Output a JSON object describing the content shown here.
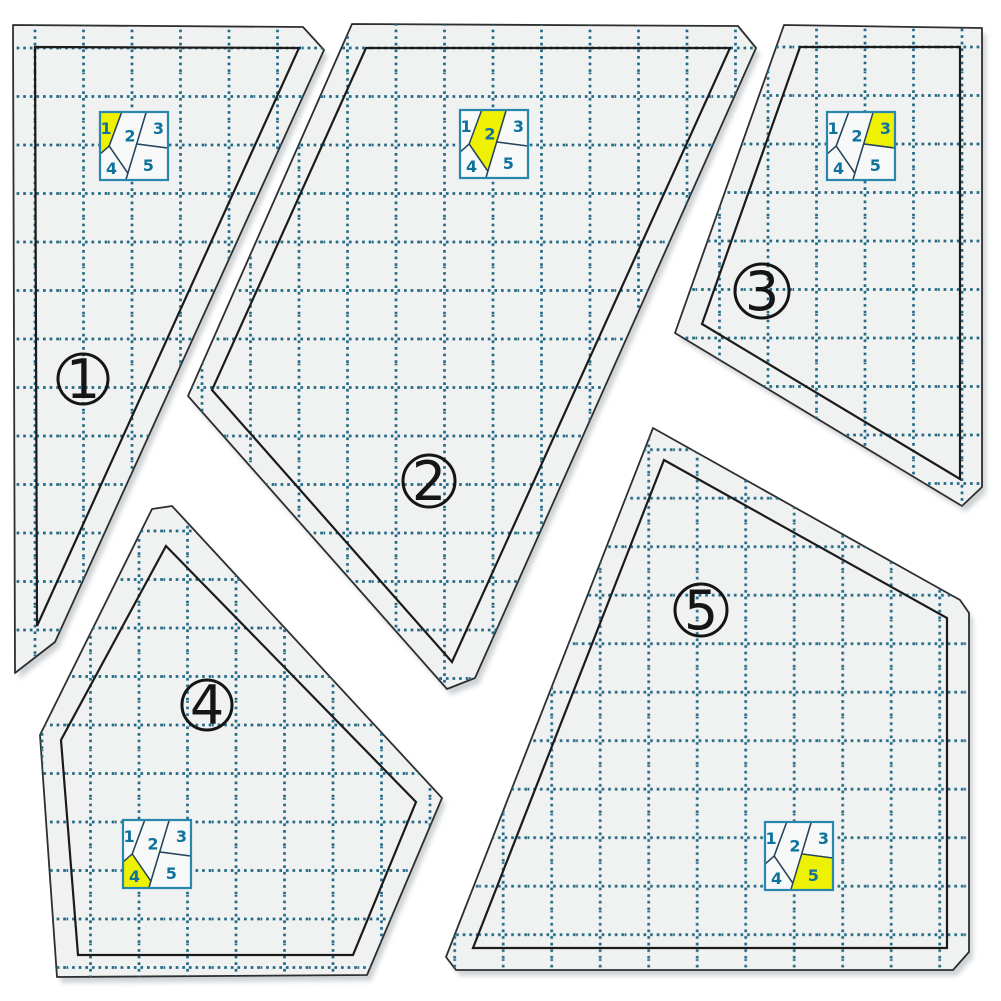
{
  "canvas": {
    "width": 1001,
    "height": 1001,
    "background": "#ffffff"
  },
  "colors": {
    "page_bg": "#ffffff",
    "template_fill": "#f0f1f1",
    "template_edge": "#2e2e2e",
    "seam_line": "#1b1b1b",
    "grid": "#236a86",
    "shadow": "#a8aeb4",
    "badge_stroke": "#151515",
    "badge_number": "#151515",
    "diagram_bg": "#f7f8f8",
    "diagram_border": "#2787ac",
    "diagram_line": "#24455c",
    "diagram_number": "#0f729c",
    "highlight_yellow": "#eff103"
  },
  "grid": {
    "spacing": 48.5,
    "dash": "2.7 3.9",
    "stroke_width": 2.7
  },
  "block_pattern": {
    "pieces": [
      {
        "id": 1,
        "label": "1",
        "points": [
          [
            0,
            0
          ],
          [
            0.32,
            0
          ],
          [
            0.135,
            0.5
          ],
          [
            0,
            0.62
          ]
        ],
        "label_pos": [
          0.09,
          0.24
        ]
      },
      {
        "id": 2,
        "label": "2",
        "points": [
          [
            0.32,
            0
          ],
          [
            0.68,
            0
          ],
          [
            0.41,
            0.9
          ],
          [
            0.135,
            0.5
          ]
        ],
        "label_pos": [
          0.44,
          0.35
        ]
      },
      {
        "id": 3,
        "label": "3",
        "points": [
          [
            0.68,
            0
          ],
          [
            1,
            0
          ],
          [
            1,
            0.53
          ],
          [
            0.54,
            0.47
          ]
        ],
        "label_pos": [
          0.86,
          0.24
        ]
      },
      {
        "id": 4,
        "label": "4",
        "points": [
          [
            0,
            0.62
          ],
          [
            0.135,
            0.5
          ],
          [
            0.41,
            0.9
          ],
          [
            0.38,
            1
          ],
          [
            0,
            1
          ]
        ],
        "label_pos": [
          0.17,
          0.83
        ]
      },
      {
        "id": 5,
        "label": "5",
        "points": [
          [
            0.54,
            0.47
          ],
          [
            1,
            0.53
          ],
          [
            1,
            1
          ],
          [
            0.38,
            1
          ],
          [
            0.41,
            0.9
          ]
        ],
        "label_pos": [
          0.71,
          0.79
        ]
      }
    ]
  },
  "templates": [
    {
      "id": 1,
      "label": "1",
      "outline": [
        [
          13,
          25
        ],
        [
          303,
          27
        ],
        [
          324,
          50
        ],
        [
          55,
          642
        ],
        [
          15,
          673
        ]
      ],
      "seam": [
        [
          35,
          47
        ],
        [
          299,
          48
        ],
        [
          37,
          626
        ]
      ],
      "badge": {
        "x": 83,
        "y": 379,
        "r": 25
      },
      "diagram": {
        "x": 100,
        "y": 112,
        "size": 68,
        "highlight": 1
      },
      "grid_offset": [
        11,
        24
      ]
    },
    {
      "id": 2,
      "label": "2",
      "outline": [
        [
          352,
          24
        ],
        [
          738,
          26
        ],
        [
          756,
          48
        ],
        [
          475,
          678
        ],
        [
          447,
          689
        ],
        [
          188,
          396
        ]
      ],
      "seam": [
        [
          366,
          48
        ],
        [
          730,
          48
        ],
        [
          452,
          662
        ],
        [
          212,
          390
        ]
      ],
      "badge": {
        "x": 429,
        "y": 481,
        "r": 26
      },
      "diagram": {
        "x": 460,
        "y": 110,
        "size": 68,
        "highlight": 2
      },
      "grid_offset": [
        32.5,
        24
      ]
    },
    {
      "id": 3,
      "label": "3",
      "outline": [
        [
          784,
          25
        ],
        [
          982,
          28
        ],
        [
          982,
          487
        ],
        [
          962,
          506
        ],
        [
          675,
          333
        ]
      ],
      "seam": [
        [
          800,
          47
        ],
        [
          960,
          47
        ],
        [
          960,
          479
        ],
        [
          702,
          324
        ]
      ],
      "badge": {
        "x": 762,
        "y": 291,
        "r": 27
      },
      "diagram": {
        "x": 827,
        "y": 112,
        "size": 68,
        "highlight": 3
      },
      "grid_offset": [
        16.5,
        23
      ]
    },
    {
      "id": 4,
      "label": "4",
      "outline": [
        [
          152,
          509
        ],
        [
          172,
          506
        ],
        [
          442,
          798
        ],
        [
          367,
          975
        ],
        [
          57,
          977
        ],
        [
          40,
          735
        ]
      ],
      "seam": [
        [
          166,
          546
        ],
        [
          416,
          802
        ],
        [
          353,
          955
        ],
        [
          78,
          955
        ],
        [
          61,
          740
        ]
      ],
      "badge": {
        "x": 207,
        "y": 705,
        "r": 25
      },
      "diagram": {
        "x": 123,
        "y": 820,
        "size": 68,
        "highlight": 4
      },
      "grid_offset": [
        18,
        22
      ]
    },
    {
      "id": 5,
      "label": "5",
      "outline": [
        [
          653,
          428
        ],
        [
          960,
          600
        ],
        [
          969,
          613
        ],
        [
          969,
          952
        ],
        [
          953,
          970
        ],
        [
          456,
          970
        ],
        [
          446,
          957
        ]
      ],
      "seam": [
        [
          664,
          460
        ],
        [
          947,
          618
        ],
        [
          947,
          948
        ],
        [
          473,
          948
        ]
      ],
      "badge": {
        "x": 701,
        "y": 610,
        "r": 26
      },
      "diagram": {
        "x": 765,
        "y": 822,
        "size": 68,
        "highlight": 5
      },
      "grid_offset": [
        42.7,
        37.7
      ]
    }
  ]
}
